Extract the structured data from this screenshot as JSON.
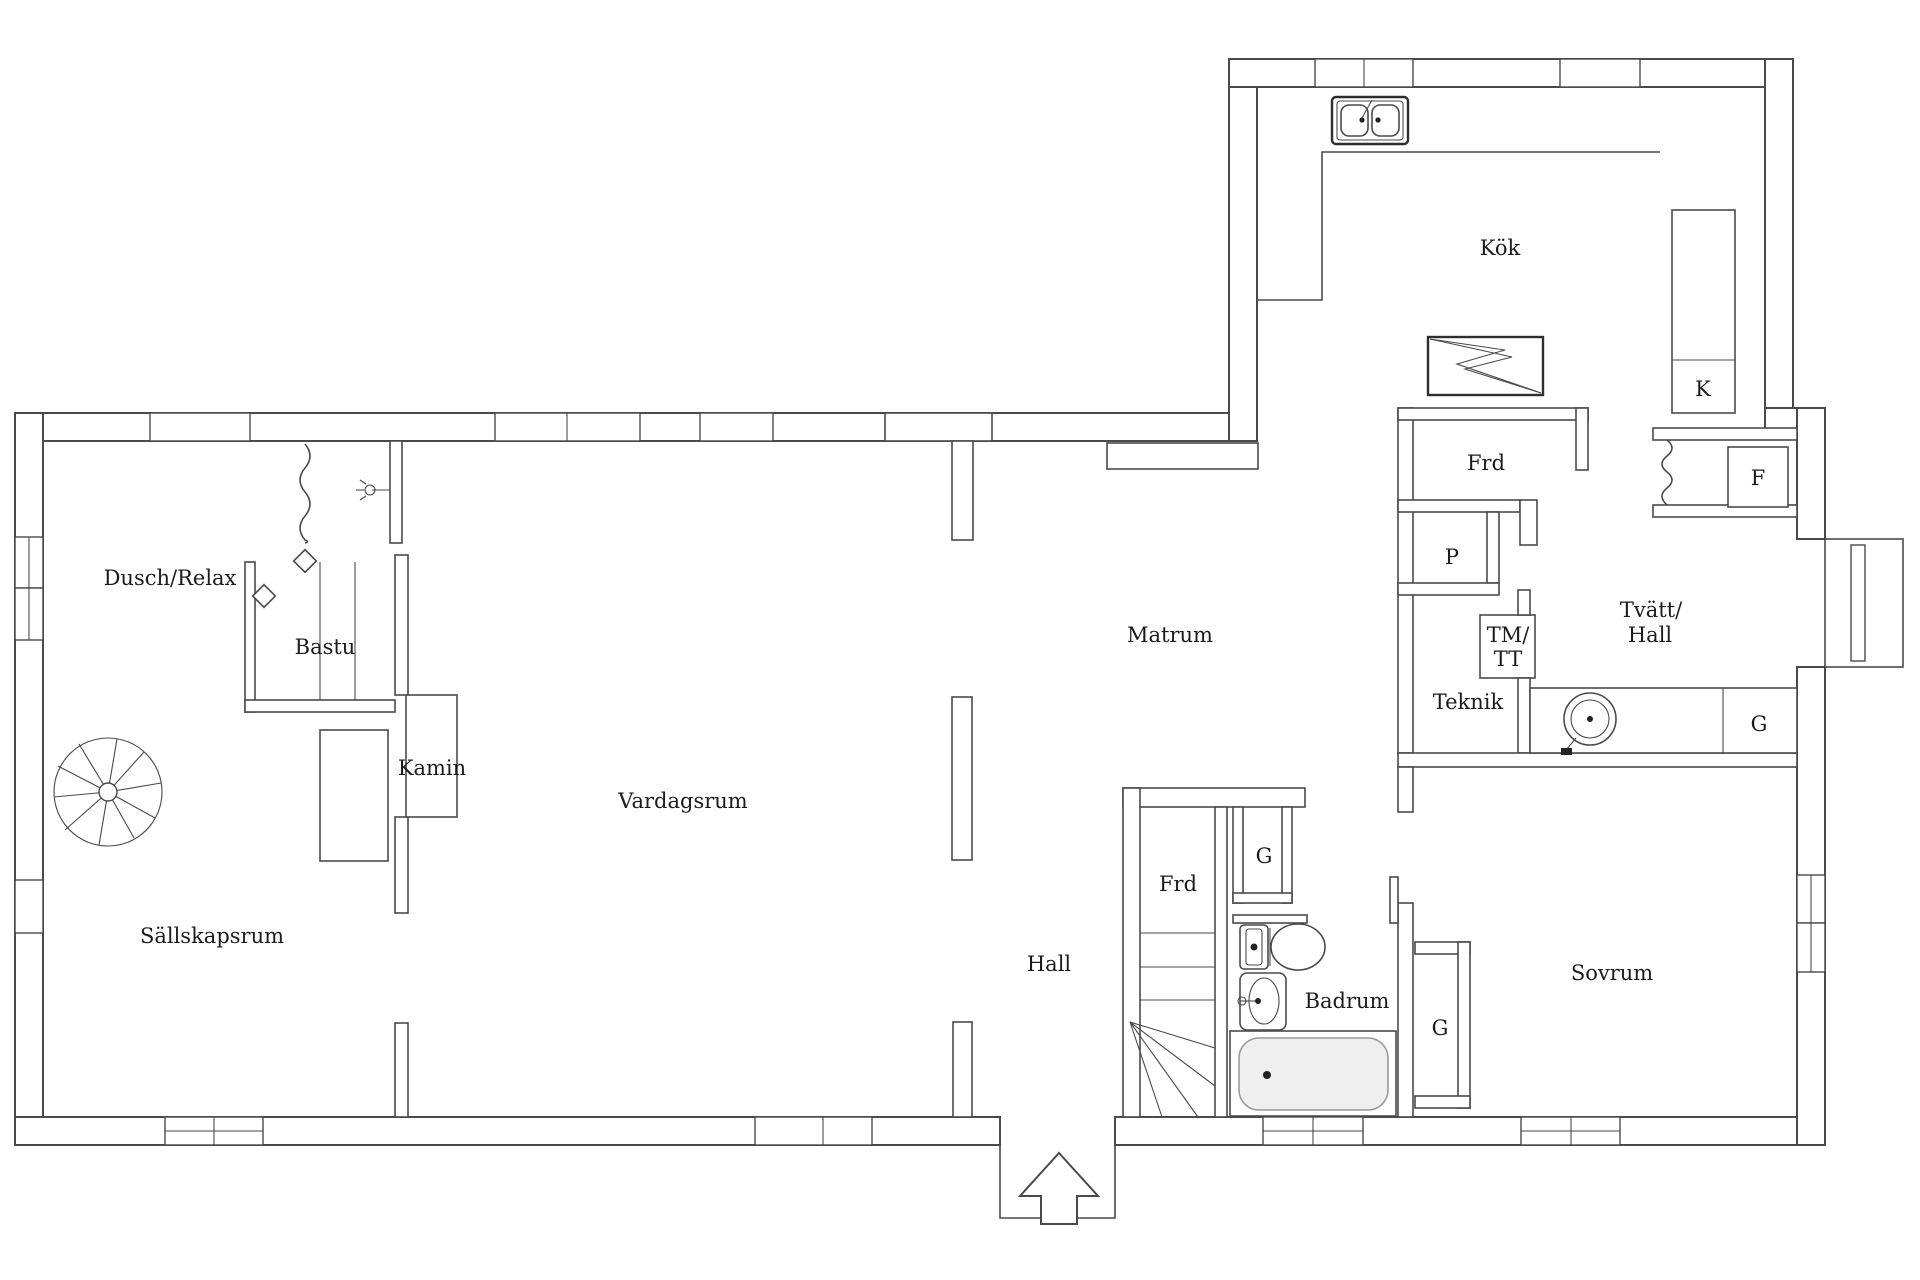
{
  "floorplan": {
    "title": "floor plan",
    "background_color": "#ffffff",
    "line_color": "#4a4a4a",
    "text_color": "#1b1b1b",
    "rooms": [
      {
        "id": "kok",
        "label": "Kök"
      },
      {
        "id": "k-cabinet",
        "label": "K"
      },
      {
        "id": "frd-top",
        "label": "Frd"
      },
      {
        "id": "f-freezer",
        "label": "F"
      },
      {
        "id": "p-closet",
        "label": "P"
      },
      {
        "id": "tvatt-line1",
        "label": "Tvätt/"
      },
      {
        "id": "tvatt-line2",
        "label": "Hall"
      },
      {
        "id": "tm-line1",
        "label": "TM/"
      },
      {
        "id": "tm-line2",
        "label": "TT"
      },
      {
        "id": "teknik",
        "label": "Teknik"
      },
      {
        "id": "g-tvatt",
        "label": "G"
      },
      {
        "id": "dusch-relax",
        "label": "Dusch/Relax"
      },
      {
        "id": "bastu",
        "label": "Bastu"
      },
      {
        "id": "kamin",
        "label": "Kamin"
      },
      {
        "id": "matrum",
        "label": "Matrum"
      },
      {
        "id": "vardagsrum",
        "label": "Vardagsrum"
      },
      {
        "id": "sallskapsrum",
        "label": "Sällskapsrum"
      },
      {
        "id": "hall",
        "label": "Hall"
      },
      {
        "id": "frd-bottom",
        "label": "Frd"
      },
      {
        "id": "g-hall",
        "label": "G"
      },
      {
        "id": "badrum",
        "label": "Badrum"
      },
      {
        "id": "g-sovrum",
        "label": "G"
      },
      {
        "id": "sovrum",
        "label": "Sovrum"
      }
    ],
    "fixtures": [
      "double-basin-kitchen-sink",
      "stove-zigzag",
      "tall-cabinet-k",
      "freezer-box-f",
      "washing-machine",
      "laundry-bench",
      "spiral-staircase",
      "straight-staircase",
      "toilet",
      "washbasin",
      "bathtub",
      "fireplace-kamin",
      "shower-curtain",
      "shower-head",
      "sauna-benches",
      "entrance-arrow",
      "bay-window",
      "windows"
    ]
  }
}
